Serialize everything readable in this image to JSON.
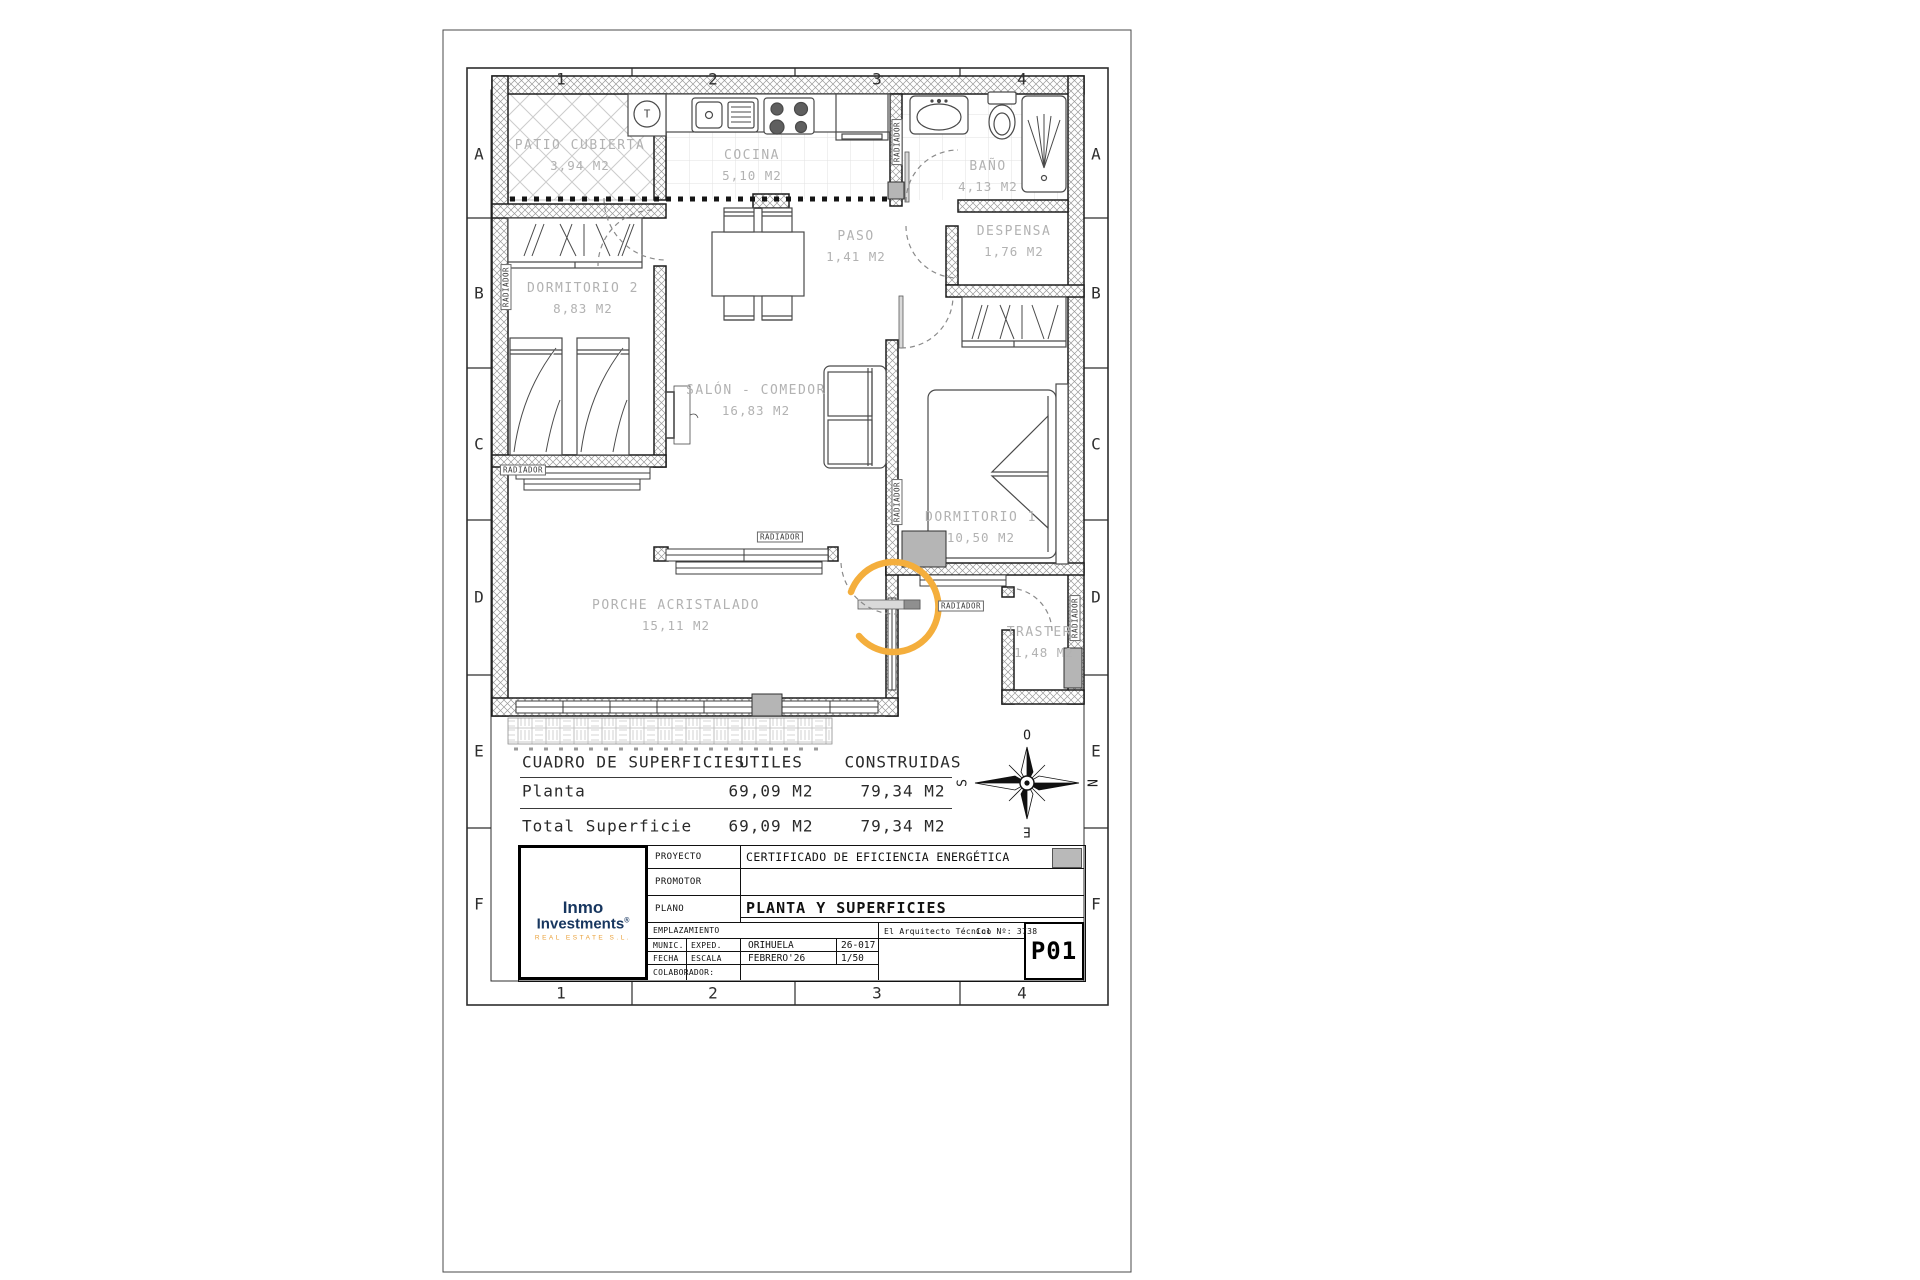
{
  "sheet": {
    "grid_cols": [
      "1",
      "2",
      "3",
      "4"
    ],
    "grid_rows": [
      "A",
      "B",
      "C",
      "D",
      "E",
      "F"
    ]
  },
  "labels": {
    "radiador": "RADIADOR",
    "thermostat": "T"
  },
  "rooms": [
    {
      "name": "PATIO CUBIERTA",
      "area": "3,94 M2"
    },
    {
      "name": "COCINA",
      "area": "5,10 M2"
    },
    {
      "name": "BAÑO",
      "area": "4,13 M2"
    },
    {
      "name": "PASO",
      "area": "1,41 M2"
    },
    {
      "name": "DESPENSA",
      "area": "1,76 M2"
    },
    {
      "name": "DORMITORIO 2",
      "area": "8,83 M2"
    },
    {
      "name": "SALÓN - COMEDOR",
      "area": "16,83 M2"
    },
    {
      "name": "DORMITORIO 1",
      "area": "10,50 M2"
    },
    {
      "name": "PORCHE ACRISTALADO",
      "area": "15,11 M2"
    },
    {
      "name": "TRASTERO",
      "area": "1,48 M2"
    }
  ],
  "surface_table": {
    "title": "CUADRO DE SUPERFICIES",
    "col_utiles": "UTILES",
    "col_construidas": "CONSTRUIDAS",
    "rows": [
      {
        "label": "Planta",
        "utiles": "69,09 M2",
        "construidas": "79,34 M2"
      },
      {
        "label": "Total Superficie",
        "utiles": "69,09 M2",
        "construidas": "79,34 M2"
      }
    ]
  },
  "compass": {
    "north": "N",
    "south": "S",
    "east": "E",
    "west": "O"
  },
  "title_block": {
    "proyecto_label": "PROYECTO",
    "proyecto_value": "CERTIFICADO DE EFICIENCIA ENERGÉTICA",
    "promotor_label": "PROMOTOR",
    "plano_label": "PLANO",
    "plano_value": "PLANTA Y SUPERFICIES",
    "emplazamiento_label": "EMPLAZAMIENTO",
    "munic_label": "MUNIC.",
    "exped_label": "EXPED.",
    "munic_value": "ORIHUELA",
    "exped_value": "26-017",
    "fecha_label": "FECHA",
    "escala_label": "ESCALA",
    "fecha_value": "FEBRERO'26",
    "escala_value": "1/50",
    "colaborador_label": "COLABORADOR:",
    "arquitecto": "El Arquitecto Técnico",
    "col_num": "Col Nº: 3738",
    "sheet_number": "P01",
    "logo": {
      "line1": "Inmo",
      "line2": "Investments",
      "reg": "®",
      "subtitle": "REAL ESTATE S.L."
    }
  },
  "colors": {
    "accent_orange": "#F4AE3C",
    "logo_blue": "#17365F",
    "logo_orange": "#E9A13B",
    "gray_box": "#b5b5b5"
  }
}
